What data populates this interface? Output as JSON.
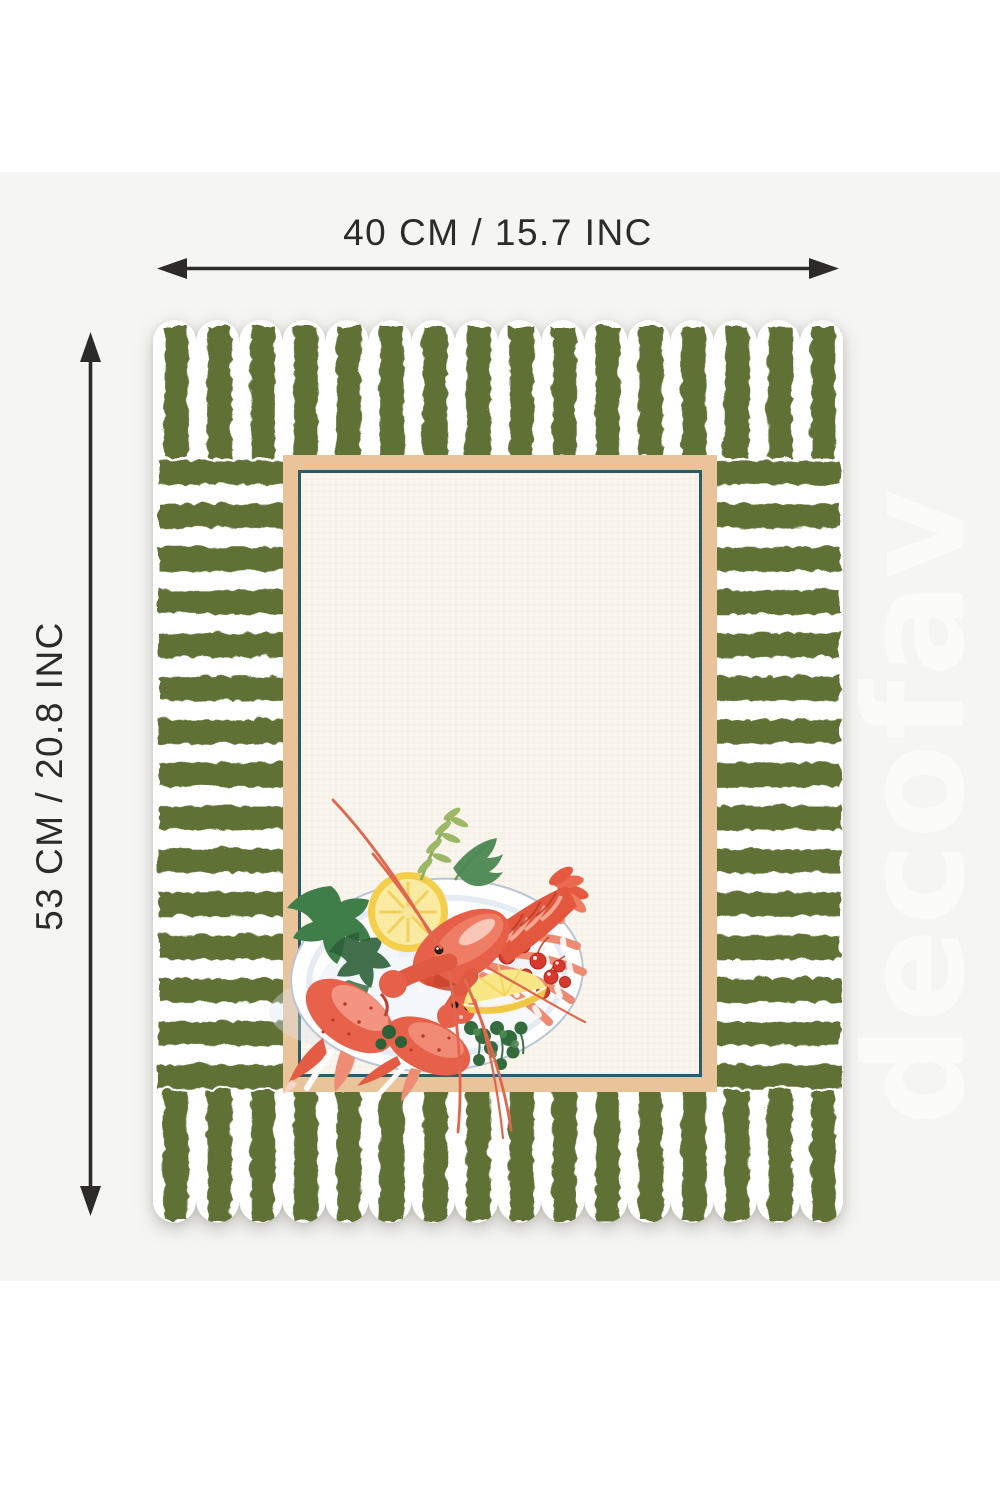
{
  "dimension_labels": {
    "width": "40 CM / 15.7 INC",
    "height": "53 CM / 20.8 INC"
  },
  "watermark": {
    "text": "decofav"
  },
  "placemat": {
    "illustration": "lobster-platter-watercolor",
    "colors": {
      "stripe_green": "#5e7134",
      "stripe_white": "#ffffff",
      "frame_tan": "#e9c49a",
      "frame_teal": "#2c5b63",
      "panel_cream": "#faf6ee",
      "lobster_red": "#e2573e",
      "lemon_yellow": "#f4cf4b",
      "leaf_green": "#3f7d49",
      "berry_red": "#d8392d",
      "plate_white": "#ffffff"
    }
  },
  "page": {
    "canvas_gray": "#f5f5f3",
    "background_white": "#ffffff",
    "annotation_color": "#2d2b28",
    "watermark_color": "#fbfbf9"
  }
}
